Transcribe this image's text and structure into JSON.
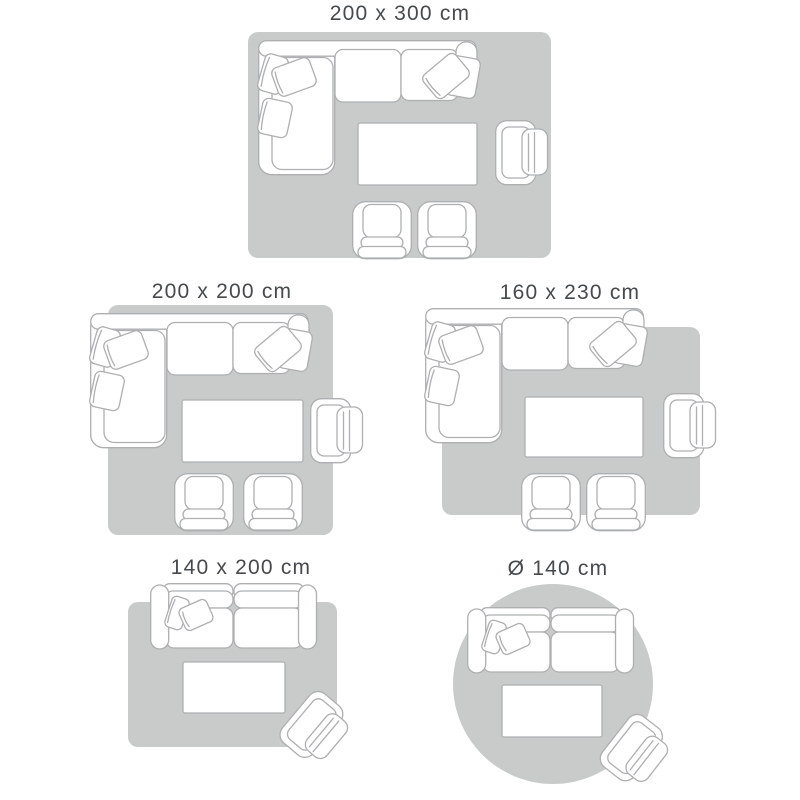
{
  "colors": {
    "background": "#ffffff",
    "rug_fill": "#c9caca",
    "furniture_fill": "#ffffff",
    "furniture_outline": "#aeafb1",
    "label_text": "#46494d"
  },
  "panels": [
    {
      "label": "200 x 300 cm",
      "rug_shape": "rectangle",
      "rug_width_cm": 200,
      "rug_length_cm": 300,
      "furniture": [
        "corner-sofa",
        "coffee-table",
        "armchair",
        "club-chair",
        "club-chair"
      ]
    },
    {
      "label": "200 x 200 cm",
      "rug_shape": "rectangle",
      "rug_width_cm": 200,
      "rug_length_cm": 200,
      "furniture": [
        "corner-sofa",
        "coffee-table",
        "armchair",
        "club-chair",
        "club-chair"
      ]
    },
    {
      "label": "160 x 230 cm",
      "rug_shape": "rectangle",
      "rug_width_cm": 160,
      "rug_length_cm": 230,
      "furniture": [
        "corner-sofa",
        "coffee-table",
        "armchair",
        "club-chair",
        "club-chair"
      ]
    },
    {
      "label": "140 x 200 cm",
      "rug_shape": "rectangle",
      "rug_width_cm": 140,
      "rug_length_cm": 200,
      "furniture": [
        "two-seat-sofa",
        "coffee-table",
        "armchair"
      ]
    },
    {
      "label": "Ø 140 cm",
      "rug_shape": "circle",
      "rug_diameter_cm": 140,
      "furniture": [
        "two-seat-sofa",
        "coffee-table",
        "armchair"
      ]
    }
  ]
}
